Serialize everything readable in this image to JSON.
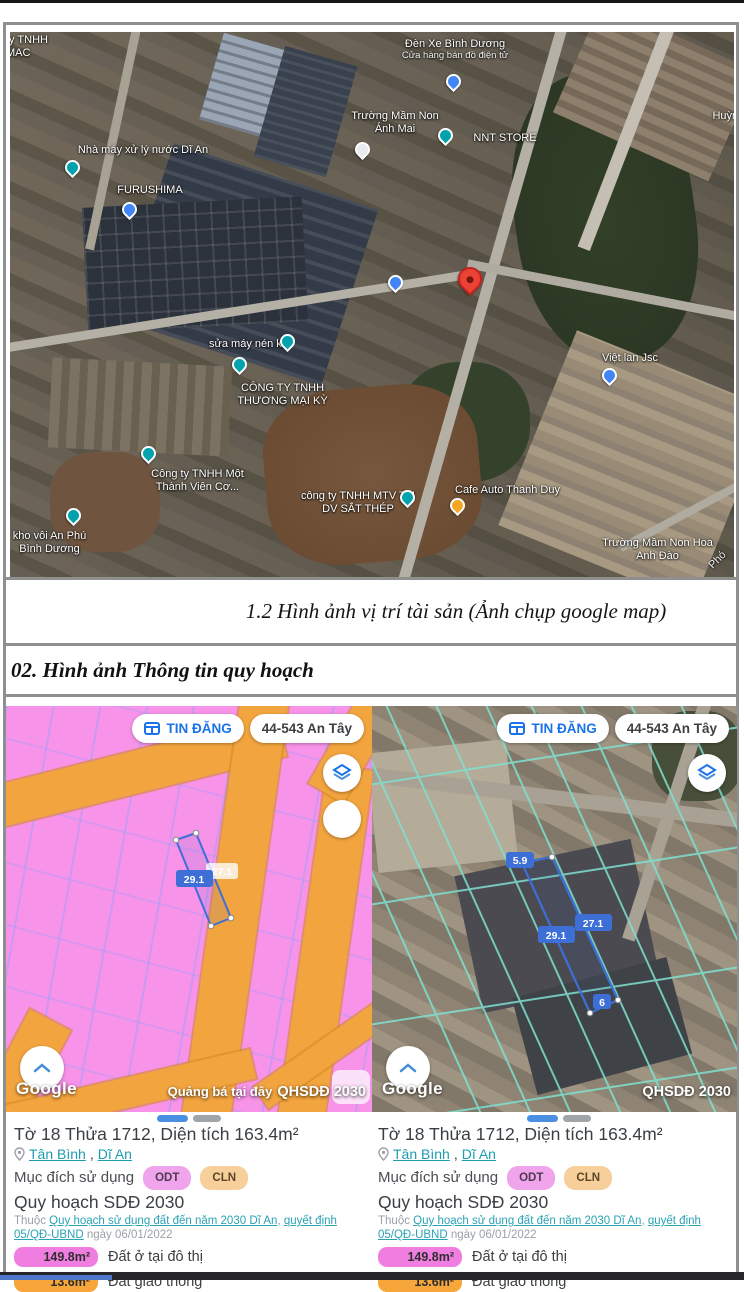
{
  "page": {
    "caption": "1.2 Hình ảnh vị trí tài sản (Ảnh chụp google map)",
    "section_title": "02. Hình ảnh Thông tin quy hoạch"
  },
  "satellite_map": {
    "labels": [
      {
        "text": "ty TNHH MAC"
      },
      {
        "text": "Đèn Xe Bình Dương",
        "sub": "Cửa hàng bán đồ điện tử"
      },
      {
        "text": "Trường Mầm Non Ánh Mai"
      },
      {
        "text": "NNT STORE"
      },
      {
        "text": "Huỳnh Hùn"
      },
      {
        "text": "Nhà máy xử lý nước Dĩ An"
      },
      {
        "text": "FURUSHIMA"
      },
      {
        "text": "Việt lan Jsc"
      },
      {
        "text": "sửa máy nén khí"
      },
      {
        "text": "CÔNG TY TNHH THƯƠNG MẠI KỲ"
      },
      {
        "text": "Công ty TNHH Một Thành Viên Cơ..."
      },
      {
        "text": "kho vôi An Phú Bình Dương"
      },
      {
        "text": "công ty TNHH MTV TM DV SẮT THÉP"
      },
      {
        "text": "Cafe Auto Thanh Duy"
      },
      {
        "text": "Trường Mầm Non Hoa Anh Đào"
      },
      {
        "text": "Phó"
      }
    ]
  },
  "map_ui": {
    "tin_dang_label": "TIN ĐĂNG",
    "address_label": "44-543 An Tây",
    "google_watermark": "Google",
    "ad_watermark": "Quảng bá tại đây",
    "qhsdd_watermark": "QHSDĐ 2030"
  },
  "left_map": {
    "measurements": {
      "m29": "29.1",
      "m27": "27.1"
    }
  },
  "right_map": {
    "measurements": {
      "m59": "5.9",
      "m29": "29.1",
      "m27": "27.1",
      "m6": "6"
    }
  },
  "parcel_info": {
    "title": "Tờ 18 Thửa 1712, Diện tích 163.4m²",
    "location_1": "Tân Bình",
    "location_separator": ", ",
    "location_2": "Dĩ An",
    "purpose_label": "Mục đích sử dụng",
    "badge_odt": "ODT",
    "badge_cln": "CLN",
    "plan_title": "Quy hoạch SDĐ 2030",
    "plan_prefix": "Thuộc ",
    "plan_link_1": "Quy hoạch sử dụng đất đến năm 2030 Dĩ An",
    "plan_separator": ", ",
    "plan_link_2": "quyết định 05/QĐ-UBND",
    "plan_date": " ngày 06/01/2022",
    "area_1_value": "149.8m²",
    "area_1_label": "Đất ở tại đô thị",
    "area_2_value": "13.6m²",
    "area_2_label": "Đất giao thông"
  },
  "colors": {
    "odt_pink": "#f793e8",
    "road_orange": "#f2a43e",
    "link_teal": "#1d9db0",
    "google_blue": "#1a73e8",
    "parcel_blue": "#3d6fd6",
    "area_badge_pink": "#f07de0",
    "area_badge_orange": "#f6a63b"
  }
}
